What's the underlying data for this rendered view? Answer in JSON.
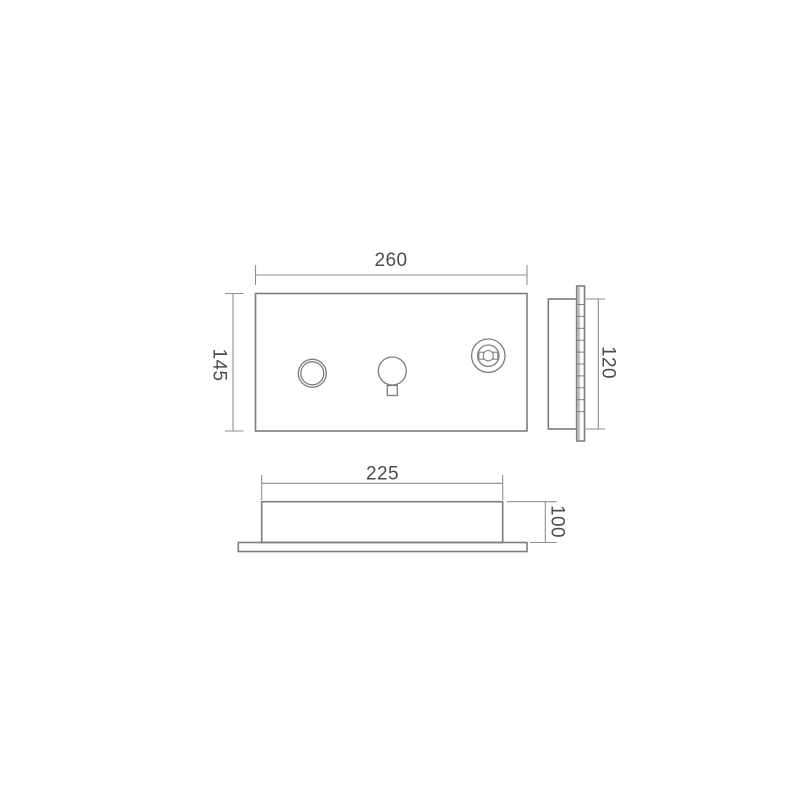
{
  "page": {
    "background": "#ffffff"
  },
  "drawing": {
    "line_color": "#7d7d7d",
    "dim_line_color": "#8f8f8f",
    "text_color": "#4c4c4c",
    "views": {
      "front": {
        "width_label": "260",
        "height_label": "145"
      },
      "side": {
        "height_label": "120"
      },
      "bottom": {
        "width_label": "225",
        "height_label": "100"
      }
    }
  }
}
